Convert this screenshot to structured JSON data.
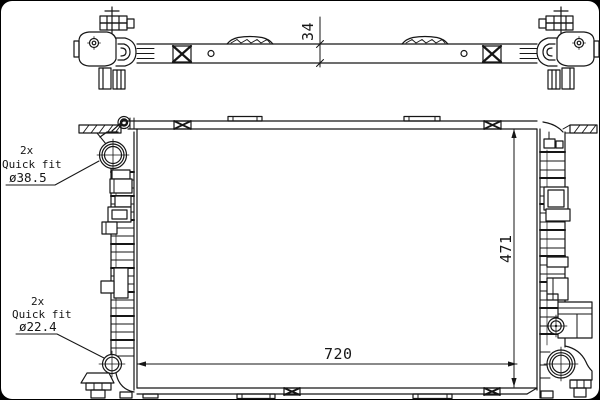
{
  "dimensions": {
    "top_depth": "34",
    "core_height": "471",
    "core_width": "720"
  },
  "callouts": {
    "upper": {
      "qty": "2x",
      "name": "Quick fit",
      "diameter": "ø38.5"
    },
    "lower": {
      "qty": "2x",
      "name": "Quick fit",
      "diameter": "ø22.4"
    }
  },
  "colors": {
    "line": "#161616",
    "background": "#ffffff",
    "frame": "#000000"
  }
}
